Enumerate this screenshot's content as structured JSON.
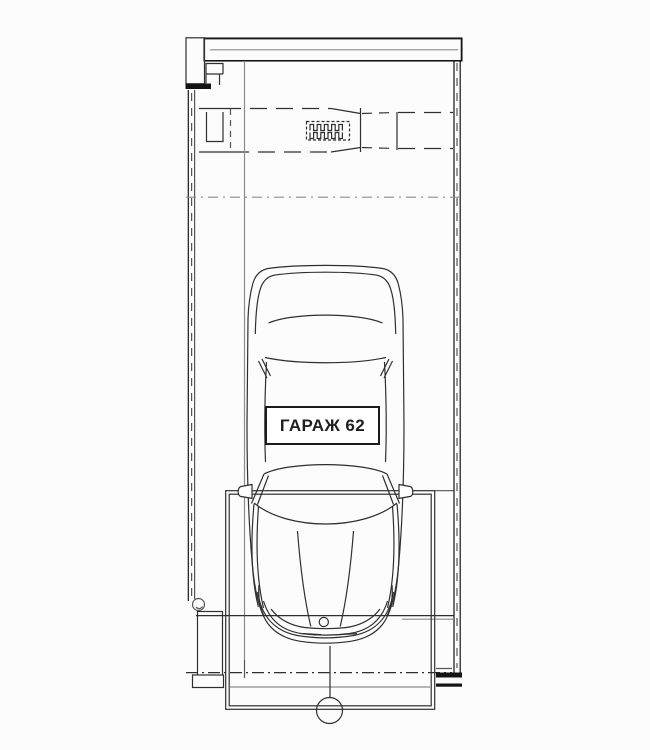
{
  "plan": {
    "label": "ГАРАЖ 62",
    "figures": {
      "car": "car-top-view-icon",
      "top_wall": "hatched-wall-icon",
      "side_walls": "layered-wall-lines-icon",
      "jamb_blocks": "crosshatched-jamb-icon",
      "door_mechanism": "spring-symbol-icon",
      "axis_marker": "circle-marker-icon"
    }
  },
  "colors": {
    "paper": "#fcfcfc",
    "ink": "#2f2f2f",
    "ink_strong": "#141414",
    "ink_mid": "#555555",
    "ink_light": "#8c8c8c",
    "label_bg": "#ffffff",
    "label_border": "#1b1b1b",
    "label_text": "#1f1f1f"
  }
}
